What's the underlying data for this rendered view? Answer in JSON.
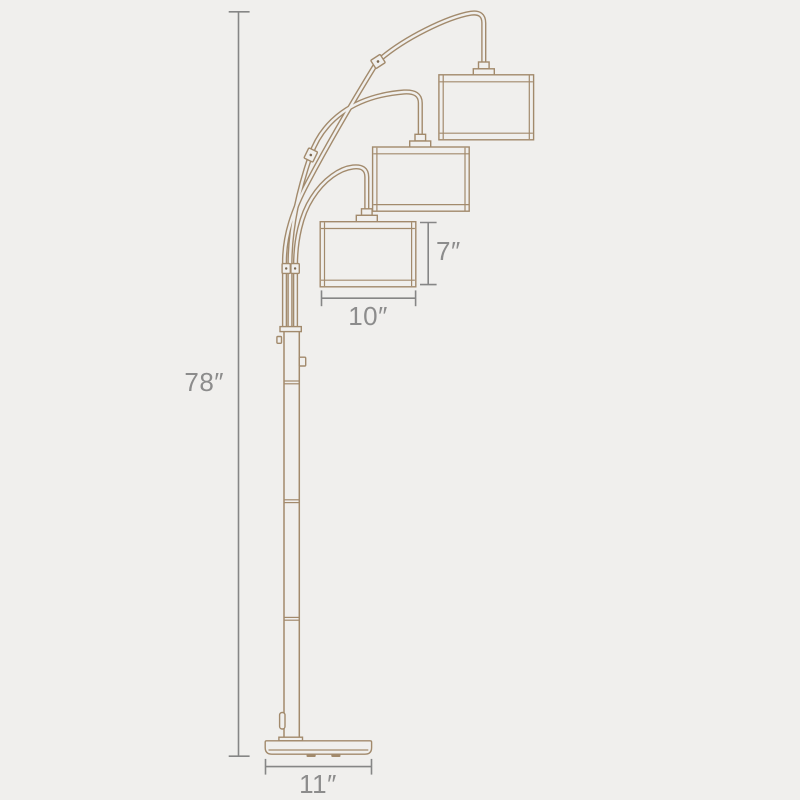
{
  "diagram": {
    "subject": "Three-light arc floor lamp dimension drawing",
    "colors": {
      "bg": "#f0efed",
      "lamp-line": "#a28a6c",
      "lamp-dark": "#7c6850",
      "dim-line": "#868686",
      "dim-text": "#8c8c8c"
    },
    "dimensions": {
      "overall_height": "78″",
      "shade_height": "7″",
      "shade_width": "10″",
      "base_width": "11″"
    }
  }
}
